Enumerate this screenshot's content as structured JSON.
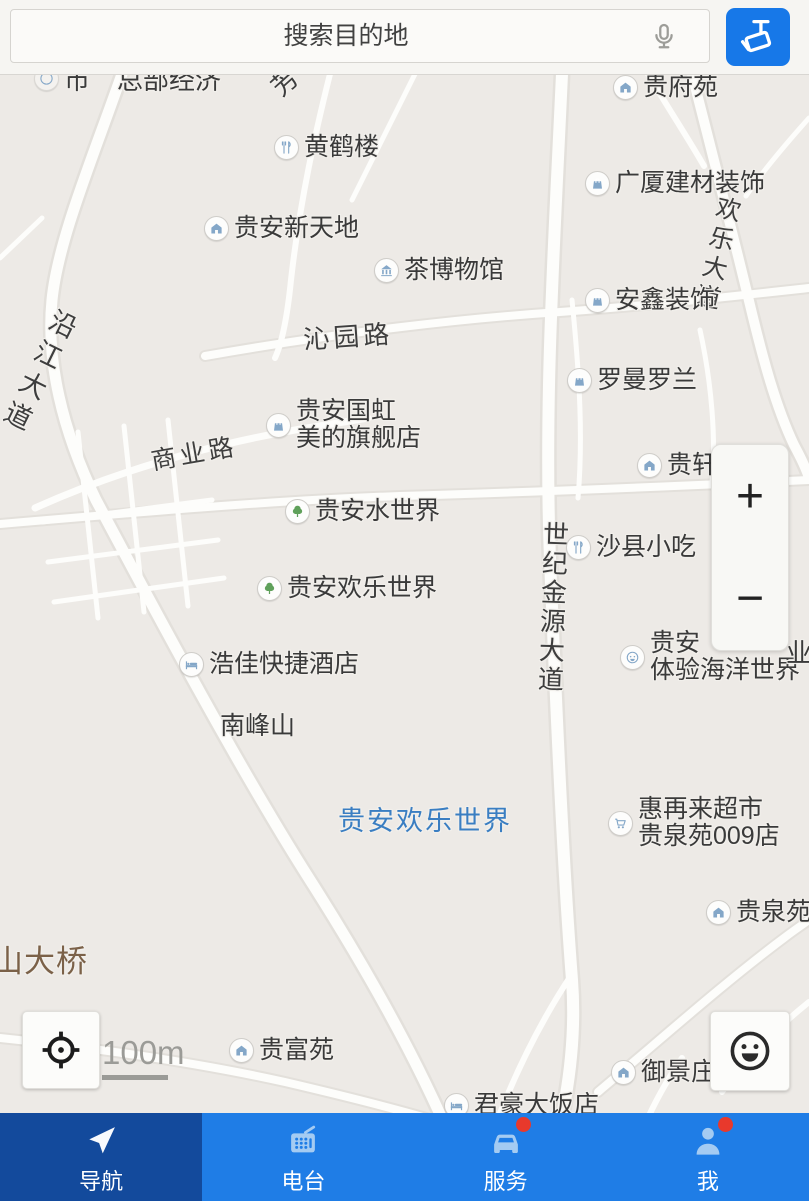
{
  "search": {
    "placeholder": "搜索目的地",
    "mic_icon": "microphone-icon",
    "camera_icon": "traffic-camera-icon"
  },
  "zoom_controls": {
    "zoom_in": "+",
    "zoom_out": "−"
  },
  "scale": {
    "label": "100m"
  },
  "map": {
    "area_label": {
      "text": "贵安欢乐世界",
      "color": "#3A7EC2"
    },
    "bridge_label": {
      "text": "山大桥",
      "color": "#7B6148"
    },
    "road_labels": [
      {
        "text": "沿江大道",
        "x": 50,
        "y": 302,
        "vertical": true,
        "rotate": 26,
        "size": 27,
        "spacing": 7
      },
      {
        "text": "商业路",
        "x": 148,
        "y": 442,
        "vertical": false,
        "rotate": -10,
        "size": 25,
        "spacing": 4
      },
      {
        "text": "沁园路",
        "x": 302,
        "y": 320,
        "vertical": false,
        "rotate": -4,
        "size": 26,
        "spacing": 4
      },
      {
        "text": "世纪金源大道",
        "x": 537,
        "y": 520,
        "vertical": true,
        "rotate": 2,
        "size": 26,
        "spacing": 3
      },
      {
        "text": "欢乐大道",
        "x": 712,
        "y": 192,
        "vertical": true,
        "rotate": 13,
        "size": 25,
        "spacing": 5
      },
      {
        "text": "芳",
        "x": 262,
        "y": 76,
        "vertical": false,
        "rotate": -42,
        "size": 26,
        "spacing": 0
      }
    ],
    "fragments": [
      {
        "text": "市",
        "icon": "circle-icon",
        "x": 34,
        "y": 60
      },
      {
        "text": "总部经济",
        "x": 117,
        "y": 60
      },
      {
        "text": "业",
        "x": 786,
        "y": 633
      }
    ],
    "pois": [
      {
        "name": "贵府苑",
        "icon": "house-icon",
        "x": 613,
        "y": 74,
        "lines": [
          "贵府苑"
        ]
      },
      {
        "name": "黄鹤楼",
        "icon": "restaurant-icon",
        "x": 274,
        "y": 134,
        "lines": [
          "黄鹤楼"
        ]
      },
      {
        "name": "广厦建材装饰",
        "icon": "bag-icon",
        "x": 585,
        "y": 170,
        "lines": [
          "广厦建材装饰"
        ]
      },
      {
        "name": "贵安新天地",
        "icon": "house-icon",
        "x": 204,
        "y": 215,
        "lines": [
          "贵安新天地"
        ]
      },
      {
        "name": "茶博物馆",
        "icon": "museum-icon",
        "x": 374,
        "y": 257,
        "lines": [
          "茶博物馆"
        ]
      },
      {
        "name": "安鑫装饰",
        "icon": "bag-icon",
        "x": 585,
        "y": 287,
        "lines": [
          "安鑫装饰"
        ]
      },
      {
        "name": "罗曼罗兰",
        "icon": "bag-icon",
        "x": 567,
        "y": 367,
        "lines": [
          "罗曼罗兰"
        ]
      },
      {
        "name": "贵安国虹美的旗舰店",
        "icon": "bag-icon",
        "x": 266,
        "y": 398,
        "lines": [
          "贵安国虹",
          "美的旗舰店"
        ]
      },
      {
        "name": "贵轩",
        "icon": "house-icon",
        "x": 637,
        "y": 452,
        "lines": [
          "贵轩"
        ]
      },
      {
        "name": "贵安水世界",
        "icon": "tree-icon",
        "x": 285,
        "y": 498,
        "lines": [
          "贵安水世界"
        ]
      },
      {
        "name": "沙县小吃",
        "icon": "restaurant-icon",
        "x": 566,
        "y": 534,
        "lines": [
          "沙县小吃"
        ]
      },
      {
        "name": "贵安欢乐世界",
        "icon": "tree-icon",
        "x": 257,
        "y": 575,
        "lines": [
          "贵安欢乐世界"
        ]
      },
      {
        "name": "浩佳快捷酒店",
        "icon": "bed-icon",
        "x": 179,
        "y": 651,
        "lines": [
          "浩佳快捷酒店"
        ]
      },
      {
        "name": "贵安体验海洋世界",
        "icon": "face-icon",
        "x": 620,
        "y": 630,
        "lines": [
          "贵安",
          "体验海洋世界"
        ]
      },
      {
        "name": "南峰山",
        "x": 220,
        "y": 713,
        "lines": [
          "南峰山"
        ]
      },
      {
        "name": "惠再来超市贵泉苑009店",
        "icon": "cart-icon",
        "x": 608,
        "y": 796,
        "lines": [
          "惠再来超市",
          "贵泉苑009店"
        ]
      },
      {
        "name": "贵泉苑",
        "icon": "house-icon",
        "x": 706,
        "y": 899,
        "lines": [
          "贵泉苑"
        ]
      },
      {
        "name": "贵富苑",
        "icon": "house-icon",
        "x": 229,
        "y": 1037,
        "lines": [
          "贵富苑"
        ]
      },
      {
        "name": "御景庄",
        "icon": "house-icon",
        "x": 611,
        "y": 1059,
        "lines": [
          "御景庄"
        ]
      },
      {
        "name": "君豪大饭店",
        "icon": "bed-icon",
        "x": 444,
        "y": 1092,
        "lines": [
          "君豪大饭店"
        ]
      }
    ]
  },
  "navbar": {
    "tabs": [
      {
        "key": "navigate",
        "label": "导航",
        "icon": "navigation-arrow-icon",
        "active": true,
        "badge": false
      },
      {
        "key": "radio",
        "label": "电台",
        "icon": "radio-icon",
        "active": false,
        "badge": false
      },
      {
        "key": "service",
        "label": "服务",
        "icon": "car-icon",
        "active": false,
        "badge": true
      },
      {
        "key": "me",
        "label": "我",
        "icon": "person-icon",
        "active": false,
        "badge": true
      }
    ]
  },
  "colors": {
    "navbar": "#1F7DE6",
    "navbar_active": "#134A9C",
    "accent_blue": "#1778E8",
    "badge_red": "#E8392C",
    "area_label_blue": "#3A7EC2",
    "bridge_brown": "#7B6148",
    "map_background": "#EDEAE6",
    "road_fill": "#FDFDFB"
  }
}
